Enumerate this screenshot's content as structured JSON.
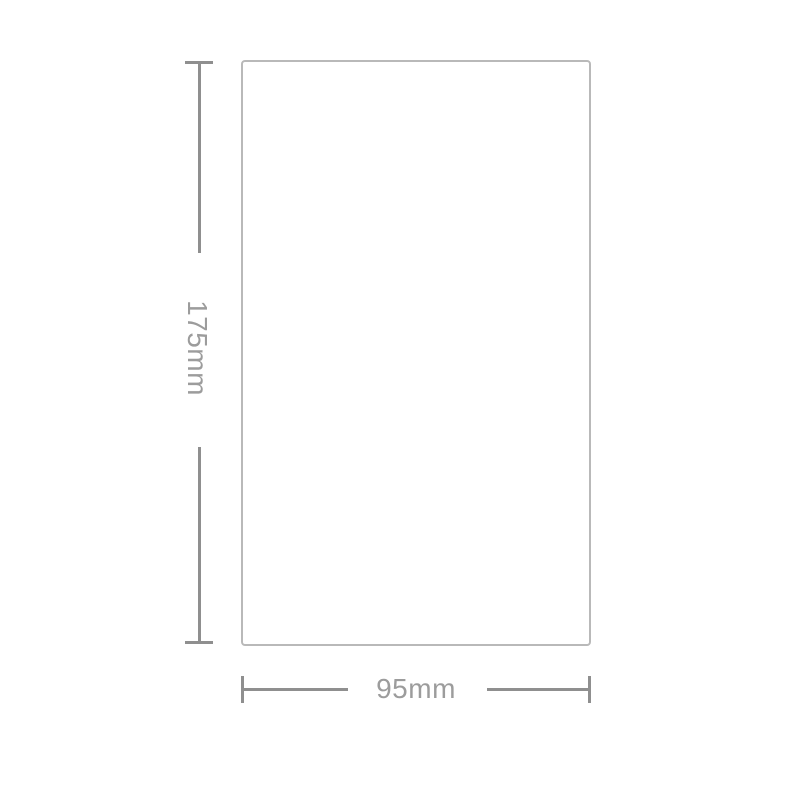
{
  "diagram": {
    "type": "product-dimension-spec",
    "height_label": "175mm",
    "width_label": "95mm"
  },
  "colors": {
    "background": "#ffffff",
    "outline_border": "#b9b9b9",
    "dimension_line": "#8f8f8f",
    "label_text": "#9c9c9c"
  }
}
